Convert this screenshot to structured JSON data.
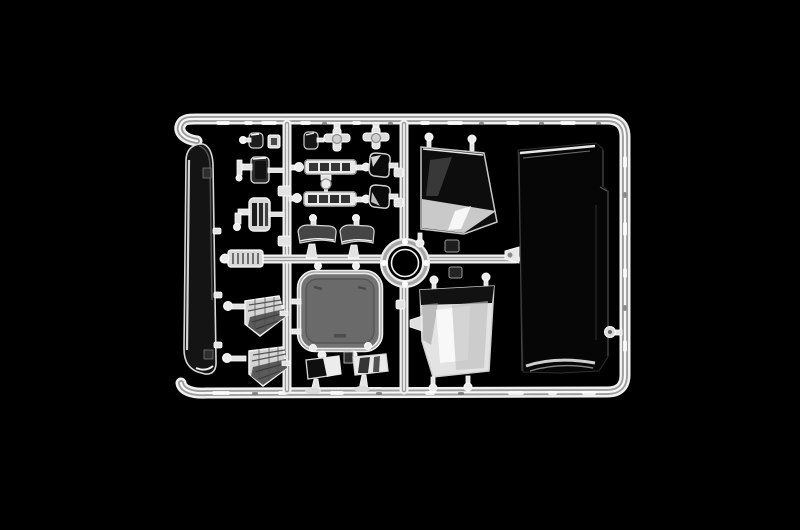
{
  "image": {
    "type": "photograph",
    "subject": "clear transparent plastic model-kit sprue (parts tree) on black background",
    "orientation": "landscape"
  },
  "colors": {
    "background": "#000000",
    "plastic_bright": "#f0f0f0",
    "plastic_mid": "#c9c9c9",
    "plastic_shadow": "#9d9d9d",
    "glass_dark": "#0e0e0e",
    "glass_tint": "#3e3e3e",
    "reflection_white": "#fafafa",
    "sunroof_gray": "#6f6f6f",
    "visor_gray": "#474747"
  },
  "parts": [
    {
      "id": "frame-rails",
      "label": "outer sprue frame with hooked ends"
    },
    {
      "id": "left-vertical-runner",
      "label": "left vertical runner"
    },
    {
      "id": "center-vertical-runner",
      "label": "center vertical runner"
    },
    {
      "id": "middle-horizontal-runner",
      "label": "middle horizontal runner"
    },
    {
      "id": "injection-ring-hub",
      "label": "circular injection ring hub"
    },
    {
      "id": "curved-deflector-strip",
      "label": "tall curved clear strip part"
    },
    {
      "id": "small-lens-a",
      "label": "small dark lens part"
    },
    {
      "id": "small-lens-b",
      "label": "small dark lens part"
    },
    {
      "id": "clip-a",
      "label": "small clip part"
    },
    {
      "id": "cross-fitting-a",
      "label": "cross shaped fitting"
    },
    {
      "id": "cross-fitting-b",
      "label": "cross shaped fitting"
    },
    {
      "id": "marker-light-bar-top",
      "label": "segmented marker light bar"
    },
    {
      "id": "marker-light-bar-bottom",
      "label": "segmented marker light bar"
    },
    {
      "id": "mirror-glass-top",
      "label": "dark mirror glass"
    },
    {
      "id": "mirror-glass-bottom",
      "label": "dark mirror glass"
    },
    {
      "id": "bar-link-connector",
      "label": "T link connector with knob"
    },
    {
      "id": "sun-visor-left",
      "label": "dark sun visor blade"
    },
    {
      "id": "sun-visor-right",
      "label": "dark sun visor blade"
    },
    {
      "id": "lamp-housing-a",
      "label": "lamp housing with bracket arm"
    },
    {
      "id": "lamp-housing-b",
      "label": "striped lamp housing with bracket arm"
    },
    {
      "id": "grille-light-lens",
      "label": "hatched grille light lens"
    },
    {
      "id": "sunroof-glass",
      "label": "rounded rectangular sunroof glass"
    },
    {
      "id": "door-mirror-left",
      "label": "rectangular mirror glass"
    },
    {
      "id": "door-mirror-right",
      "label": "rectangular mirror glass"
    },
    {
      "id": "headlamp-lens-upper",
      "label": "hatched headlamp lens"
    },
    {
      "id": "headlamp-lens-lower",
      "label": "hatched headlamp lens"
    },
    {
      "id": "side-window-upper",
      "label": "trapezoid side window glass"
    },
    {
      "id": "side-window-lower",
      "label": "trapezoid side window glass"
    },
    {
      "id": "windshield-glass",
      "label": "large windshield panel"
    },
    {
      "id": "windshield-left-tab",
      "label": "windshield left gate tab"
    },
    {
      "id": "windshield-right-knob",
      "label": "windshield right gate knob"
    }
  ]
}
